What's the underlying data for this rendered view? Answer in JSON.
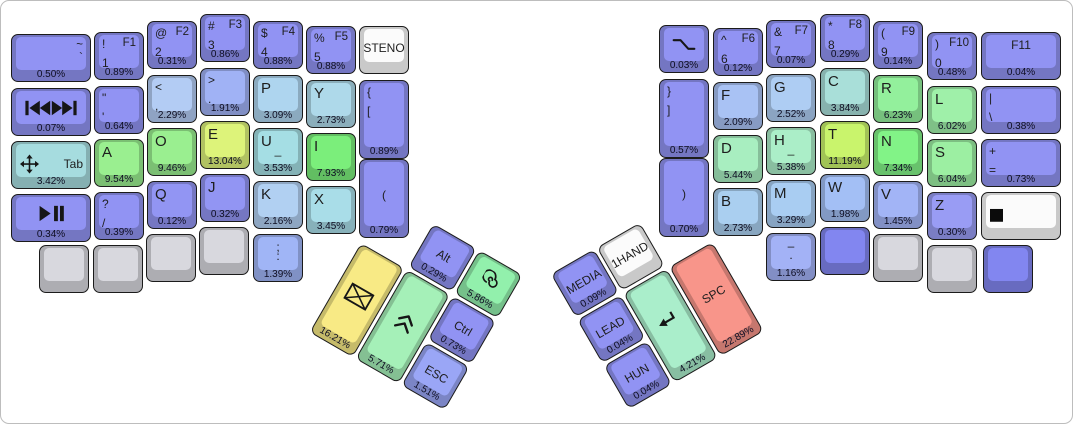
{
  "canvas": {
    "bg": "#ffffff",
    "border": "#bdbdbd"
  },
  "left_keys": [
    {
      "name": "key-grave",
      "x": 10,
      "y": 33,
      "w": 80,
      "h": 48,
      "color": "#9193f3",
      "labels": {
        "tr": "~",
        "mr": "`"
      },
      "pct": "0.50%"
    },
    {
      "name": "key-skip-track",
      "x": 10,
      "y": 87,
      "w": 80,
      "h": 48,
      "color": "#9193f3",
      "icon": "skip-track",
      "labels": {},
      "pct": "0.07%"
    },
    {
      "name": "key-tab",
      "x": 10,
      "y": 140,
      "w": 80,
      "h": 48,
      "color": "#a6dcdf",
      "icon": "move",
      "labels": {
        "mr": "Tab"
      },
      "pct": "3.42%"
    },
    {
      "name": "key-play-pause",
      "x": 10,
      "y": 193,
      "w": 80,
      "h": 48,
      "color": "#9193f3",
      "icon": "play-pause",
      "labels": {},
      "pct": "0.34%"
    },
    {
      "name": "key-1",
      "x": 93,
      "y": 31,
      "w": 50,
      "h": 48,
      "color": "#9193f3",
      "labels": {
        "tl": "!",
        "tr": "F1",
        "ml": "1"
      },
      "pct": "0.89%"
    },
    {
      "name": "key-quote",
      "x": 93,
      "y": 85,
      "w": 50,
      "h": 48,
      "color": "#9193f3",
      "labels": {
        "tl": "\"",
        "ml": "'"
      },
      "pct": "0.64%"
    },
    {
      "name": "key-a",
      "x": 93,
      "y": 138,
      "w": 50,
      "h": 48,
      "color": "#9aef90",
      "labels": {
        "tl": "A"
      },
      "pct": "9.54%"
    },
    {
      "name": "key-question-slash",
      "x": 93,
      "y": 191,
      "w": 50,
      "h": 48,
      "color": "#9193f3",
      "labels": {
        "tl": "?",
        "ml": "/"
      },
      "pct": "0.39%"
    },
    {
      "name": "key-blank-gray-1",
      "x": 38,
      "y": 244,
      "w": 50,
      "h": 48,
      "color": "#d8d8de",
      "labels": {},
      "pct": null
    },
    {
      "name": "key-blank-gray-2",
      "x": 92,
      "y": 244,
      "w": 50,
      "h": 48,
      "color": "#d8d8de",
      "labels": {},
      "pct": null
    },
    {
      "name": "key-2",
      "x": 146,
      "y": 20,
      "w": 50,
      "h": 48,
      "color": "#9193f3",
      "labels": {
        "tl": "@",
        "tr": "F2",
        "ml": "2"
      },
      "pct": "0.31%"
    },
    {
      "name": "key-comma",
      "x": 146,
      "y": 74,
      "w": 50,
      "h": 48,
      "color": "#b3ccf4",
      "labels": {
        "tl": "<",
        "ml": ","
      },
      "pct": "2.29%"
    },
    {
      "name": "key-o",
      "x": 146,
      "y": 127,
      "w": 50,
      "h": 48,
      "color": "#9aef90",
      "labels": {
        "tl": "O"
      },
      "pct": "9.46%"
    },
    {
      "name": "key-q",
      "x": 146,
      "y": 180,
      "w": 50,
      "h": 48,
      "color": "#9295f3",
      "labels": {
        "tl": "Q"
      },
      "pct": "0.12%"
    },
    {
      "name": "key-blank-gray-3",
      "x": 145,
      "y": 233,
      "w": 50,
      "h": 48,
      "color": "#d8d8de",
      "labels": {},
      "pct": null
    },
    {
      "name": "key-3",
      "x": 199,
      "y": 13,
      "w": 50,
      "h": 48,
      "color": "#9193f3",
      "labels": {
        "tl": "#",
        "tr": "F3",
        "ml": "3"
      },
      "pct": "0.86%"
    },
    {
      "name": "key-period",
      "x": 199,
      "y": 67,
      "w": 50,
      "h": 48,
      "color": "#a0b2f5",
      "labels": {
        "tl": ">",
        "ml": "."
      },
      "pct": "1.91%"
    },
    {
      "name": "key-e",
      "x": 199,
      "y": 120,
      "w": 50,
      "h": 48,
      "color": "#ddf37a",
      "labels": {
        "tl": "E"
      },
      "pct": "13.04%"
    },
    {
      "name": "key-j",
      "x": 199,
      "y": 173,
      "w": 50,
      "h": 48,
      "color": "#9295f3",
      "labels": {
        "tl": "J"
      },
      "pct": "0.32%"
    },
    {
      "name": "key-blank-gray-4",
      "x": 198,
      "y": 226,
      "w": 50,
      "h": 48,
      "color": "#d8d8de",
      "labels": {},
      "pct": null
    },
    {
      "name": "key-4",
      "x": 252,
      "y": 20,
      "w": 50,
      "h": 48,
      "color": "#9193f3",
      "labels": {
        "tl": "$",
        "tr": "F4",
        "ml": "4"
      },
      "pct": "0.88%"
    },
    {
      "name": "key-p",
      "x": 252,
      "y": 74,
      "w": 50,
      "h": 48,
      "color": "#aed5ef",
      "labels": {
        "tl": "P"
      },
      "pct": "3.09%"
    },
    {
      "name": "key-u",
      "x": 252,
      "y": 127,
      "w": 50,
      "h": 48,
      "color": "#a5dee4",
      "labels": {
        "tl": "U",
        "ctr": "_"
      },
      "pct": "3.53%"
    },
    {
      "name": "key-k",
      "x": 252,
      "y": 180,
      "w": 50,
      "h": 48,
      "color": "#b1d0f2",
      "labels": {
        "tl": "K"
      },
      "pct": "2.16%"
    },
    {
      "name": "key-semicolon",
      "x": 252,
      "y": 233,
      "w": 50,
      "h": 48,
      "color": "#a0b5f6",
      "labels": {
        "tc": ";",
        "ctr": ":"
      },
      "pct": "1.39%"
    },
    {
      "name": "key-5",
      "x": 305,
      "y": 25,
      "w": 50,
      "h": 48,
      "color": "#9193f3",
      "labels": {
        "tl": "%",
        "tr": "F5",
        "ml": "5"
      },
      "pct": "0.88%"
    },
    {
      "name": "key-y",
      "x": 305,
      "y": 79,
      "w": 50,
      "h": 48,
      "color": "#aed9ea",
      "labels": {
        "tl": "Y"
      },
      "pct": "2.73%"
    },
    {
      "name": "key-i",
      "x": 305,
      "y": 132,
      "w": 50,
      "h": 48,
      "color": "#7bee7b",
      "labels": {
        "tl": "I"
      },
      "pct": "7.93%"
    },
    {
      "name": "key-x",
      "x": 305,
      "y": 185,
      "w": 50,
      "h": 48,
      "color": "#a9dde8",
      "labels": {
        "tl": "X"
      },
      "pct": "3.45%"
    },
    {
      "name": "key-steno",
      "x": 358,
      "y": 25,
      "w": 50,
      "h": 48,
      "color": "#fbfbfb",
      "labels": {
        "ctr": "STENO"
      },
      "pct": null
    },
    {
      "name": "key-left-brace",
      "x": 358,
      "y": 79,
      "w": 50,
      "h": 79,
      "color": "#9193f3",
      "labels": {
        "tl": "{",
        "ml": "["
      },
      "pct": "0.89%"
    },
    {
      "name": "key-left-paren",
      "x": 358,
      "y": 158,
      "w": 50,
      "h": 79,
      "color": "#9193f3",
      "labels": {
        "ctr": "("
      },
      "pct": "0.79%"
    }
  ],
  "right_keys": [
    {
      "name": "key-option-slope",
      "x": 658,
      "y": 24,
      "w": 50,
      "h": 48,
      "color": "#9193f3",
      "icon": "option",
      "labels": {},
      "pct": "0.03%"
    },
    {
      "name": "key-right-brace",
      "x": 658,
      "y": 78,
      "w": 50,
      "h": 79,
      "color": "#9193f3",
      "labels": {
        "tl": "}",
        "ml": "]"
      },
      "pct": "0.57%"
    },
    {
      "name": "key-right-paren",
      "x": 658,
      "y": 157,
      "w": 50,
      "h": 79,
      "color": "#9193f3",
      "labels": {
        "ctr": ")"
      },
      "pct": "0.70%"
    },
    {
      "name": "key-6",
      "x": 712,
      "y": 27,
      "w": 50,
      "h": 48,
      "color": "#9193f3",
      "labels": {
        "tl": "^",
        "tr": "F6",
        "ml": "6"
      },
      "pct": "0.12%"
    },
    {
      "name": "key-f",
      "x": 712,
      "y": 81,
      "w": 50,
      "h": 48,
      "color": "#a9c2f4",
      "labels": {
        "tl": "F"
      },
      "pct": "2.09%"
    },
    {
      "name": "key-d",
      "x": 712,
      "y": 134,
      "w": 50,
      "h": 48,
      "color": "#a8eec0",
      "labels": {
        "tl": "D"
      },
      "pct": "5.44%"
    },
    {
      "name": "key-b",
      "x": 712,
      "y": 187,
      "w": 50,
      "h": 48,
      "color": "#aacff0",
      "labels": {
        "tl": "B"
      },
      "pct": "2.73%"
    },
    {
      "name": "key-7",
      "x": 765,
      "y": 19,
      "w": 50,
      "h": 48,
      "color": "#9193f3",
      "labels": {
        "tl": "&",
        "tr": "F7",
        "ml": "7"
      },
      "pct": "0.07%"
    },
    {
      "name": "key-g",
      "x": 765,
      "y": 73,
      "w": 50,
      "h": 48,
      "color": "#aecdf3",
      "labels": {
        "tl": "G"
      },
      "pct": "2.52%"
    },
    {
      "name": "key-h",
      "x": 765,
      "y": 126,
      "w": 50,
      "h": 48,
      "color": "#abeec8",
      "labels": {
        "tl": "H",
        "ctr": "_"
      },
      "pct": "5.38%"
    },
    {
      "name": "key-m",
      "x": 765,
      "y": 179,
      "w": 50,
      "h": 48,
      "color": "#a9cdf2",
      "labels": {
        "tl": "M"
      },
      "pct": "3.29%"
    },
    {
      "name": "key-minus",
      "x": 765,
      "y": 232,
      "w": 50,
      "h": 48,
      "color": "#a3b2f6",
      "labels": {
        "tc": "–",
        "ctr": "."
      },
      "pct": "1.16%"
    },
    {
      "name": "key-8",
      "x": 819,
      "y": 13,
      "w": 50,
      "h": 48,
      "color": "#9193f3",
      "labels": {
        "tl": "*",
        "tr": "F8",
        "ml": "8"
      },
      "pct": "0.29%"
    },
    {
      "name": "key-c",
      "x": 819,
      "y": 67,
      "w": 50,
      "h": 48,
      "color": "#a9dfd9",
      "labels": {
        "tl": "C"
      },
      "pct": "3.84%"
    },
    {
      "name": "key-t",
      "x": 819,
      "y": 120,
      "w": 50,
      "h": 48,
      "color": "#c9f46c",
      "labels": {
        "tl": "T"
      },
      "pct": "11.19%"
    },
    {
      "name": "key-w",
      "x": 819,
      "y": 173,
      "w": 50,
      "h": 48,
      "color": "#a3bff5",
      "labels": {
        "tl": "W"
      },
      "pct": "1.98%"
    },
    {
      "name": "key-blank-purple-1",
      "x": 819,
      "y": 226,
      "w": 50,
      "h": 48,
      "color": "#8286f0",
      "labels": {},
      "pct": null
    },
    {
      "name": "key-9",
      "x": 872,
      "y": 20,
      "w": 50,
      "h": 48,
      "color": "#9193f3",
      "labels": {
        "tl": "(",
        "tr": "F9",
        "ml": "9"
      },
      "pct": "0.14%"
    },
    {
      "name": "key-r",
      "x": 872,
      "y": 74,
      "w": 50,
      "h": 48,
      "color": "#93f09c",
      "labels": {
        "tl": "R"
      },
      "pct": "6.23%"
    },
    {
      "name": "key-n",
      "x": 872,
      "y": 127,
      "w": 50,
      "h": 48,
      "color": "#82f387",
      "labels": {
        "tl": "N"
      },
      "pct": "7.34%"
    },
    {
      "name": "key-v",
      "x": 872,
      "y": 180,
      "w": 50,
      "h": 48,
      "color": "#a2b4f6",
      "labels": {
        "tl": "V"
      },
      "pct": "1.45%"
    },
    {
      "name": "key-blank-gray-5",
      "x": 872,
      "y": 233,
      "w": 50,
      "h": 48,
      "color": "#d8d8de",
      "labels": {},
      "pct": null
    },
    {
      "name": "key-0",
      "x": 926,
      "y": 31,
      "w": 50,
      "h": 48,
      "color": "#9193f3",
      "labels": {
        "tl": ")",
        "tr": "F10",
        "ml": "0"
      },
      "pct": "0.48%"
    },
    {
      "name": "key-l",
      "x": 926,
      "y": 85,
      "w": 50,
      "h": 48,
      "color": "#9ff0a9",
      "labels": {
        "tl": "L"
      },
      "pct": "6.02%"
    },
    {
      "name": "key-s",
      "x": 926,
      "y": 138,
      "w": 50,
      "h": 48,
      "color": "#9cefa2",
      "labels": {
        "tl": "S"
      },
      "pct": "6.04%"
    },
    {
      "name": "key-z",
      "x": 926,
      "y": 191,
      "w": 50,
      "h": 48,
      "color": "#999cf4",
      "labels": {
        "tl": "Z"
      },
      "pct": "0.30%"
    },
    {
      "name": "key-blank-gray-6",
      "x": 926,
      "y": 244,
      "w": 50,
      "h": 48,
      "color": "#d8d8de",
      "labels": {},
      "pct": null
    },
    {
      "name": "key-f11",
      "x": 980,
      "y": 31,
      "w": 80,
      "h": 48,
      "color": "#9193f3",
      "labels": {
        "tc": "F11"
      },
      "pct": "0.04%"
    },
    {
      "name": "key-pipe",
      "x": 980,
      "y": 85,
      "w": 80,
      "h": 48,
      "color": "#9193f3",
      "labels": {
        "tl": "|",
        "ml": "\\"
      },
      "pct": "0.38%"
    },
    {
      "name": "key-plus",
      "x": 980,
      "y": 138,
      "w": 80,
      "h": 48,
      "color": "#9193f3",
      "labels": {
        "tl": "+",
        "ml": "="
      },
      "pct": "0.73%"
    },
    {
      "name": "key-stop",
      "x": 980,
      "y": 191,
      "w": 80,
      "h": 48,
      "color": "#fbfbfb",
      "icon": "stop",
      "labels": {},
      "pct": null
    },
    {
      "name": "key-blank-purple-2",
      "x": 982,
      "y": 244,
      "w": 50,
      "h": 48,
      "color": "#8286f0",
      "labels": {},
      "pct": null
    }
  ],
  "left_thumb": {
    "x": 360,
    "y": 242,
    "angle": 30,
    "keys": [
      {
        "name": "key-alt",
        "x": 53,
        "y": -53,
        "w": 50,
        "h": 50,
        "color": "#9193f3",
        "labels": {
          "ctr": "Alt"
        },
        "pct": "0.29%"
      },
      {
        "name": "key-spiral",
        "x": 106,
        "y": -53,
        "w": 50,
        "h": 50,
        "color": "#92f0ac",
        "icon": "spiral",
        "labels": {},
        "pct": "5.86%"
      },
      {
        "name": "key-backspace",
        "x": 0,
        "y": 0,
        "w": 50,
        "h": 103,
        "color": "#f8ea85",
        "icon": "envelope",
        "labels": {},
        "pct": "16.21%"
      },
      {
        "name": "key-shift",
        "x": 53,
        "y": 0,
        "w": 50,
        "h": 103,
        "color": "#a5f0b8",
        "icon": "chevrons-up",
        "labels": {},
        "pct": "5.71%"
      },
      {
        "name": "key-ctrl",
        "x": 106,
        "y": 0,
        "w": 50,
        "h": 50,
        "color": "#9193f3",
        "labels": {
          "ctr": "Ctrl"
        },
        "pct": "0.73%"
      },
      {
        "name": "key-esc",
        "x": 106,
        "y": 53,
        "w": 50,
        "h": 50,
        "color": "#9aa6f6",
        "labels": {
          "ctr": "ESC"
        },
        "pct": "1.51%"
      }
    ]
  },
  "right_thumb": {
    "x": 668,
    "y": 266,
    "angle": -30,
    "keys": [
      {
        "name": "key-media",
        "x": -106,
        "y": -53,
        "w": 50,
        "h": 50,
        "color": "#9193f3",
        "labels": {
          "ctr": "MEDIA"
        },
        "pct": "0.09%"
      },
      {
        "name": "key-1hand",
        "x": -53,
        "y": -53,
        "w": 50,
        "h": 50,
        "color": "#fbfbfb",
        "labels": {
          "ctr": "1HAND"
        },
        "pct": null
      },
      {
        "name": "key-lead",
        "x": -106,
        "y": 0,
        "w": 50,
        "h": 50,
        "color": "#9193f3",
        "labels": {
          "ctr": "LEAD"
        },
        "pct": "0.04%"
      },
      {
        "name": "key-enter",
        "x": -53,
        "y": 0,
        "w": 50,
        "h": 103,
        "color": "#aaeecb",
        "icon": "enter",
        "labels": {},
        "pct": "4.21%"
      },
      {
        "name": "key-space",
        "x": 0,
        "y": 0,
        "w": 50,
        "h": 103,
        "color": "#f8958a",
        "labels": {
          "ctr": "SPC"
        },
        "pct": "22.89%"
      },
      {
        "name": "key-hun",
        "x": -106,
        "y": 53,
        "w": 50,
        "h": 50,
        "color": "#9193f3",
        "labels": {
          "ctr": "HUN"
        },
        "pct": "0.04%"
      }
    ]
  }
}
